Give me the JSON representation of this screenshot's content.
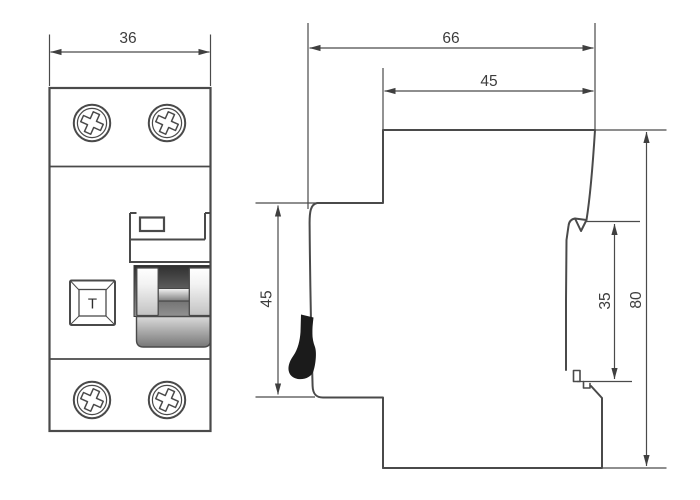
{
  "colors": {
    "background": "#ffffff",
    "line": "#4a4a4a",
    "dimension_text": "#3d3d3d",
    "lever_fill": "#1b1b1b"
  },
  "icons": {
    "terminal_screw": "phillips-screw-icon",
    "toggle": "rocker-switch-icon",
    "lever": "side-toggle-lever-icon"
  },
  "front_view": {
    "test_button_label": "T"
  },
  "dimensions": {
    "front_width": "36",
    "depth_total": "66",
    "depth_upper": "45",
    "front_height": "45",
    "rail_slot_height": "35",
    "total_height": "80"
  }
}
